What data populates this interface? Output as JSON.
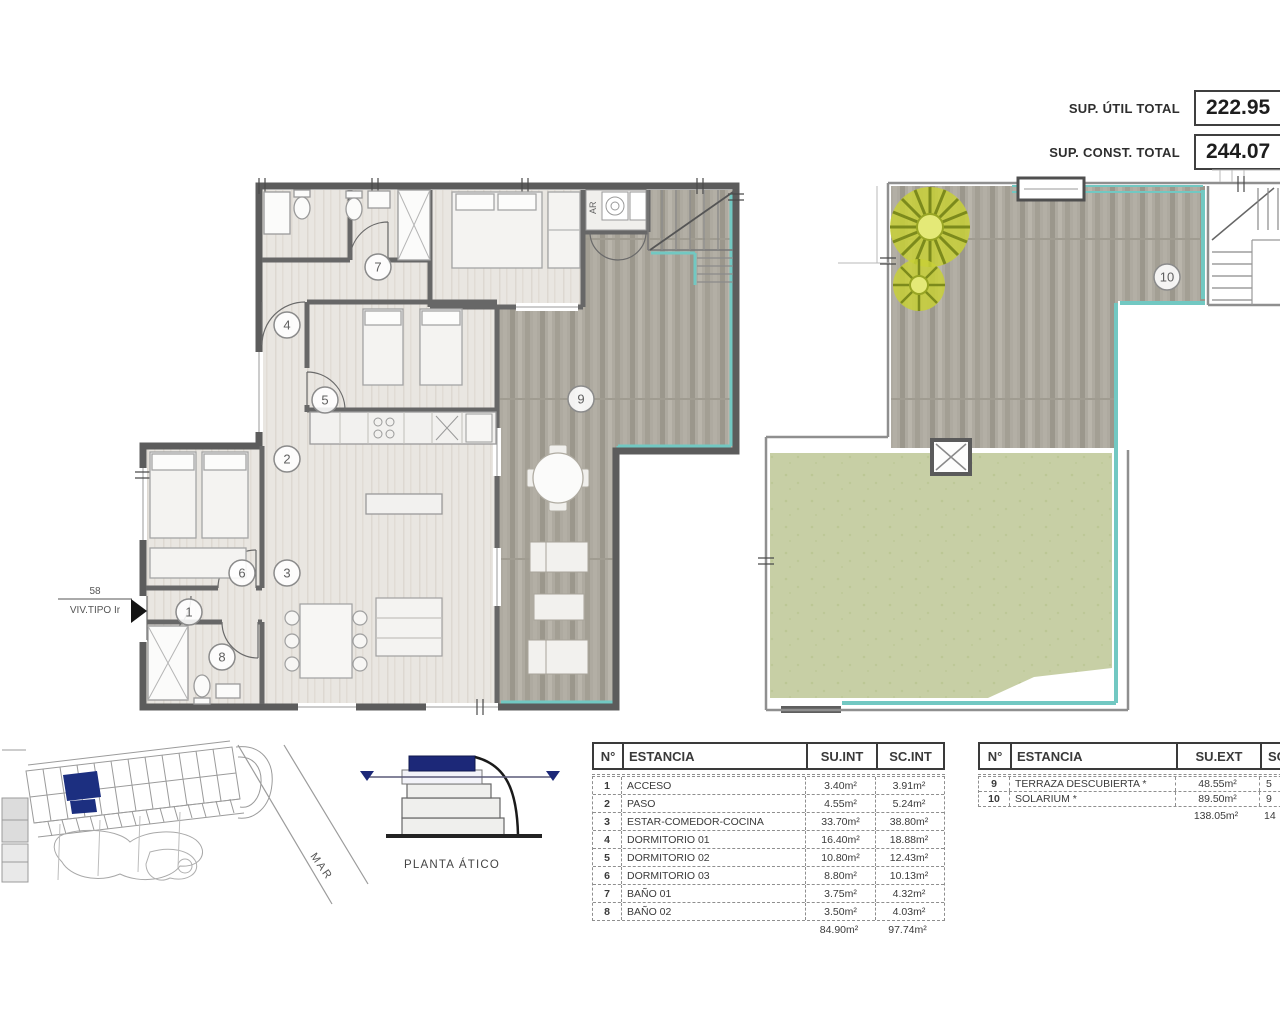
{
  "summary": {
    "rows": [
      {
        "label": "SUP. ÚTIL TOTAL",
        "value": "222.95"
      },
      {
        "label": "SUP. CONST. TOTAL",
        "value": "244.07"
      }
    ]
  },
  "unit_label": {
    "number": "58",
    "type": "VIV.TIPO Ir"
  },
  "plan_left": {
    "closet_label": "AR",
    "numbers": [
      "1",
      "2",
      "3",
      "4",
      "5",
      "6",
      "7",
      "8",
      "9"
    ]
  },
  "plan_right": {
    "number": "10"
  },
  "site": {
    "sea": "MAR"
  },
  "section": {
    "caption": "PLANTA ÁTICO"
  },
  "tables": {
    "interior": {
      "headers": {
        "num": "N°",
        "room": "ESTANCIA",
        "su": "SU.INT",
        "sc": "SC.INT"
      },
      "rows": [
        {
          "num": "1",
          "room": "ACCESO",
          "su": "3.40m²",
          "sc": "3.91m²"
        },
        {
          "num": "2",
          "room": "PASO",
          "su": "4.55m²",
          "sc": "5.24m²"
        },
        {
          "num": "3",
          "room": "ESTAR-COMEDOR-COCINA",
          "su": "33.70m²",
          "sc": "38.80m²"
        },
        {
          "num": "4",
          "room": "DORMITORIO 01",
          "su": "16.40m²",
          "sc": "18.88m²"
        },
        {
          "num": "5",
          "room": "DORMITORIO 02",
          "su": "10.80m²",
          "sc": "12.43m²"
        },
        {
          "num": "6",
          "room": "DORMITORIO 03",
          "su": "8.80m²",
          "sc": "10.13m²"
        },
        {
          "num": "7",
          "room": "BAÑO 01",
          "su": "3.75m²",
          "sc": "4.32m²"
        },
        {
          "num": "8",
          "room": "BAÑO 02",
          "su": "3.50m²",
          "sc": "4.03m²"
        }
      ],
      "total": {
        "su": "84.90m²",
        "sc": "97.74m²"
      }
    },
    "exterior": {
      "headers": {
        "num": "N°",
        "room": "ESTANCIA",
        "su": "SU.EXT",
        "sc": "SC.EXT"
      },
      "rows": [
        {
          "num": "9",
          "room": "TERRAZA DESCUBIERTA *",
          "su": "48.55m²",
          "sc": "5"
        },
        {
          "num": "10",
          "room": "SOLARIUM *",
          "su": "89.50m²",
          "sc": "9"
        }
      ],
      "total": {
        "su": "138.05m²",
        "sc": "14"
      }
    }
  }
}
